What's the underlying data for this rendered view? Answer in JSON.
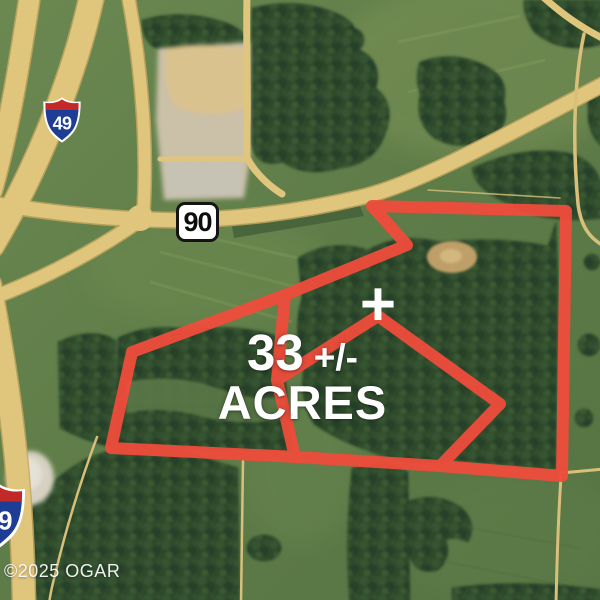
{
  "map": {
    "acreage": {
      "value": "33",
      "tolerance": "+/-",
      "unit": "ACRES"
    },
    "marker": "+",
    "signs": {
      "interstate_top_route": "49",
      "interstate_bottom_route": "49",
      "state_route": "90"
    },
    "watermark": "©2025 OGAR",
    "colors": {
      "boundary_red": "#ef4c3b",
      "road_tan": "#e0c57d",
      "field_green": "#62804b",
      "forest_green": "#2e4a2c",
      "shield_blue": "#1e3e95",
      "shield_red": "#c22a2a",
      "sign_white": "#ffffff"
    }
  }
}
